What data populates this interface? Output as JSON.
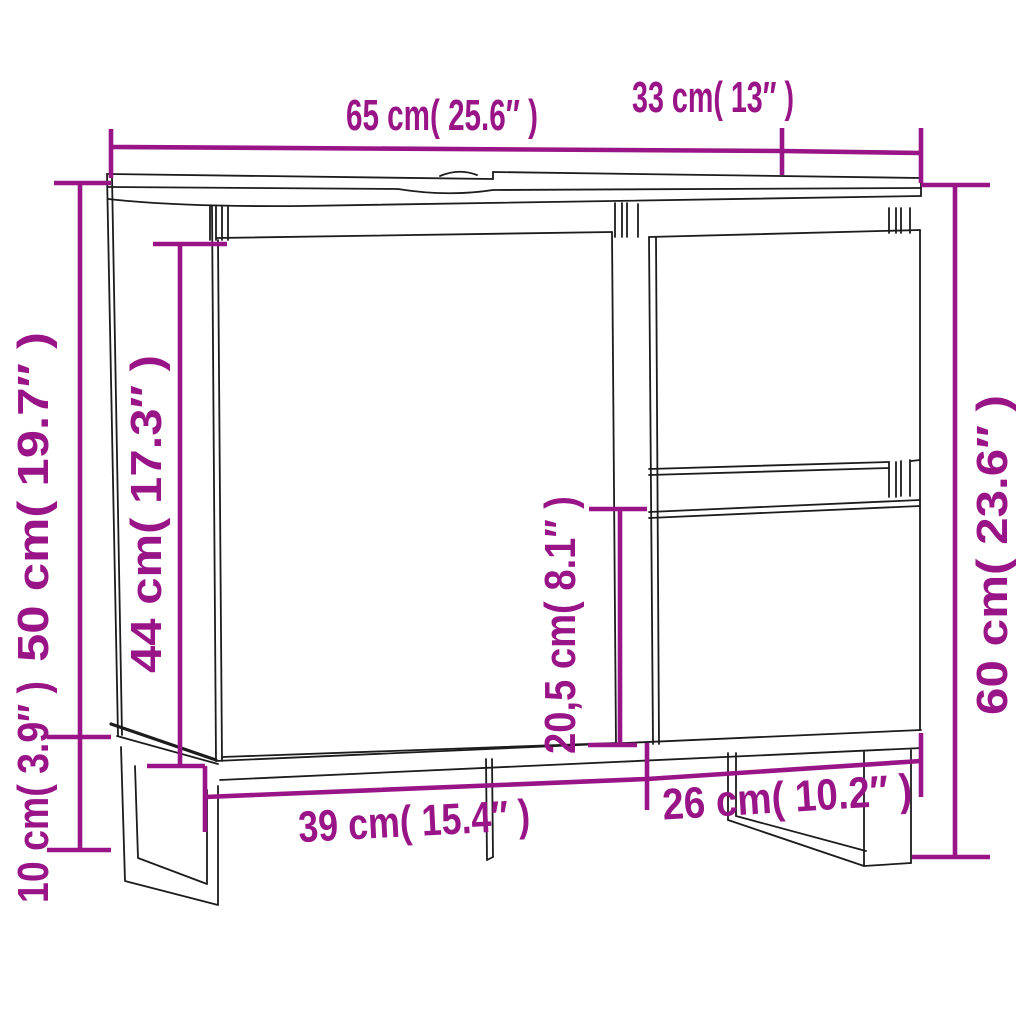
{
  "meta": {
    "type": "product-dimension-diagram",
    "product": "bathroom-sink-cabinet"
  },
  "colors": {
    "background": "#ffffff",
    "line_art": "#1c1c1c",
    "dimension_accent": "#991487"
  },
  "dimensions": {
    "top_width": {
      "label": "65 cm( 25.6″ )",
      "cm": 65,
      "inch": 25.6
    },
    "top_depth": {
      "label": "33 cm( 13″ )",
      "cm": 33,
      "inch": 13
    },
    "left_height": {
      "label": "50 cm( 19.7″ )",
      "cm": 50,
      "inch": 19.7
    },
    "door_height": {
      "label": "44 cm( 17.3″ )",
      "cm": 44,
      "inch": 17.3
    },
    "drawer_height": {
      "label": "20,5 cm( 8.1″ )",
      "cm": 20.5,
      "inch": 8.1
    },
    "right_height": {
      "label": "60 cm( 23.6″ )",
      "cm": 60,
      "inch": 23.6
    },
    "leg_height": {
      "label": "10 cm( 3.9″ )",
      "cm": 10,
      "inch": 3.9
    },
    "bottom_width_left": {
      "label": "39 cm( 15.4″ )",
      "cm": 39,
      "inch": 15.4
    },
    "bottom_width_right": {
      "label": "26 cm( 10.2″ )",
      "cm": 26,
      "inch": 10.2
    }
  }
}
